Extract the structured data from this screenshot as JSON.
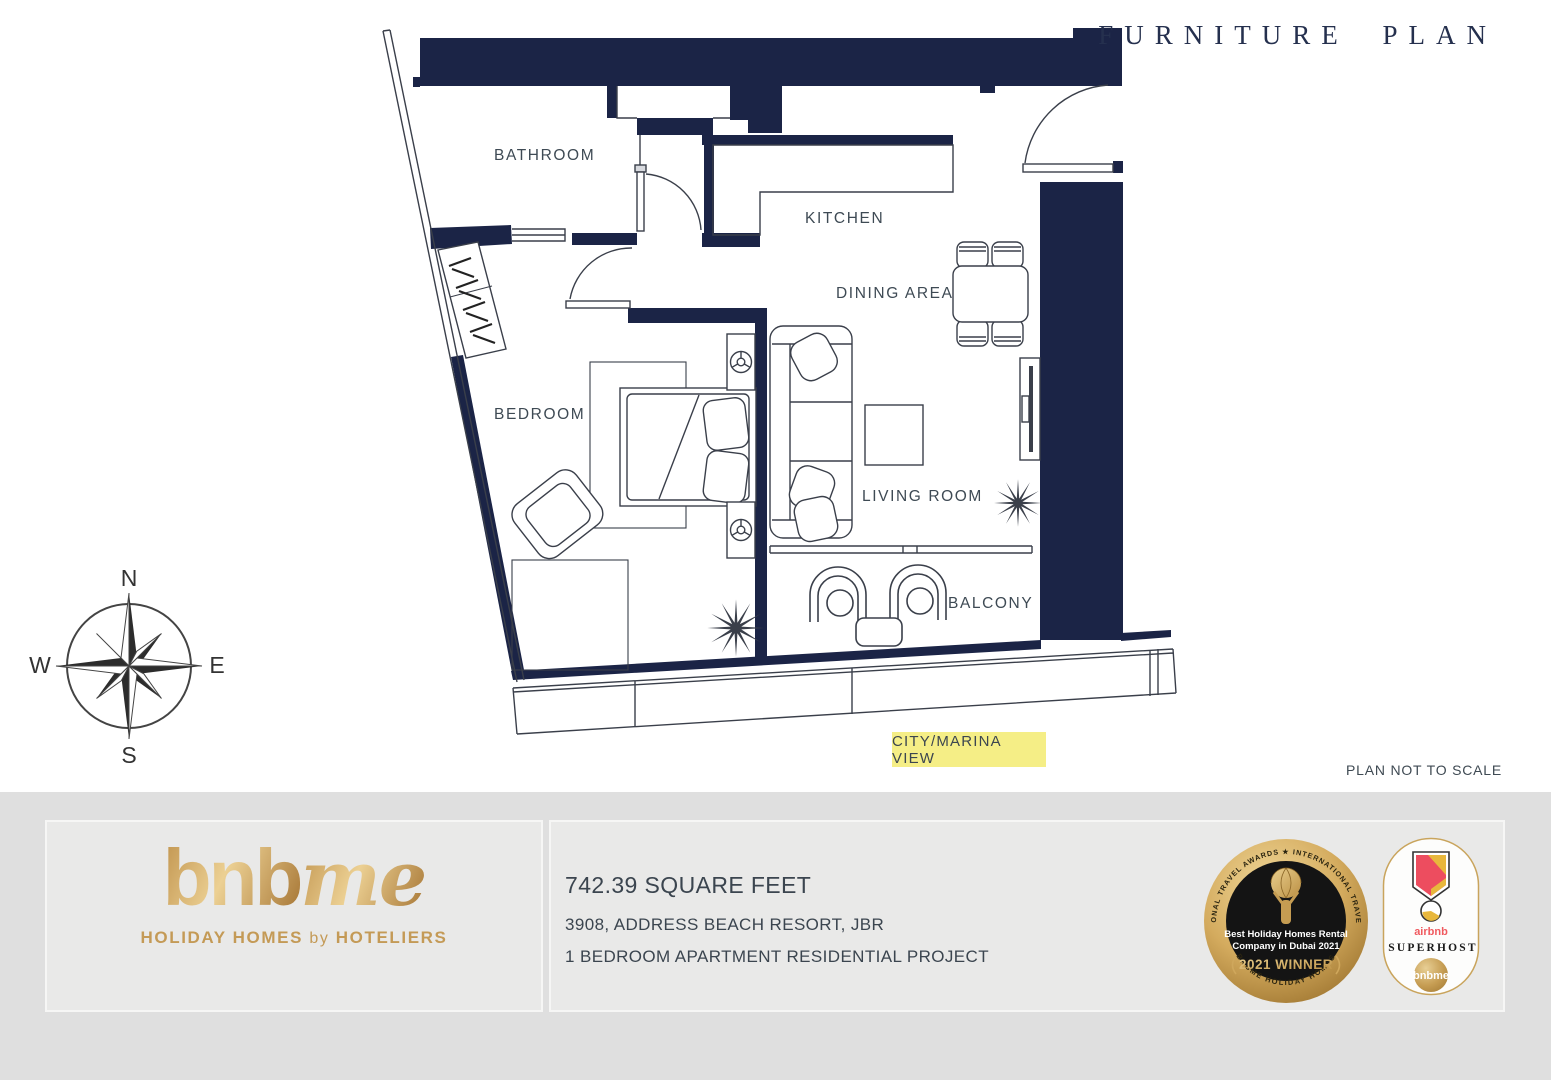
{
  "title": "FURNITURE PLAN",
  "plan": {
    "labels": {
      "bathroom": "BATHROOM",
      "kitchen": "KITCHEN",
      "dining": "DINING AREA",
      "bedroom": "BEDROOM",
      "living": "LIVING ROOM",
      "balcony": "BALCONY"
    },
    "view_label": "CITY/MARINA VIEW",
    "scale_note": "PLAN NOT TO SCALE",
    "compass": {
      "n": "N",
      "e": "E",
      "s": "S",
      "w": "W"
    },
    "colors": {
      "wall": "#1b2446",
      "view_highlight": "#f5ee86"
    }
  },
  "footer": {
    "logo": {
      "bnb": "bnb",
      "me": "me",
      "tagline_1": "HOLIDAY HOMES",
      "tagline_by": "by",
      "tagline_2": "HOTELIERS",
      "gold": "#c9a050"
    },
    "details": {
      "area": "742.39 SQUARE FEET",
      "address": "3908, ADDRESS BEACH RESORT, JBR",
      "project": "1 BEDROOM APARTMENT RESIDENTIAL PROJECT"
    },
    "award": {
      "ring_top": "★ INTERNATIONAL TRAVEL AWARDS ★ INTERNATIONAL TRAVEL AWARDS ★",
      "ring_bottom": "BNBME HOLIDAY HOMES",
      "line1": "Best Holiday Homes Rental",
      "line2": "Company in Dubai 2021",
      "winner": "2021 WINNER"
    },
    "superhost": {
      "brand": "airbnb",
      "label": "SUPERHOST",
      "sub": "bnbme"
    }
  }
}
